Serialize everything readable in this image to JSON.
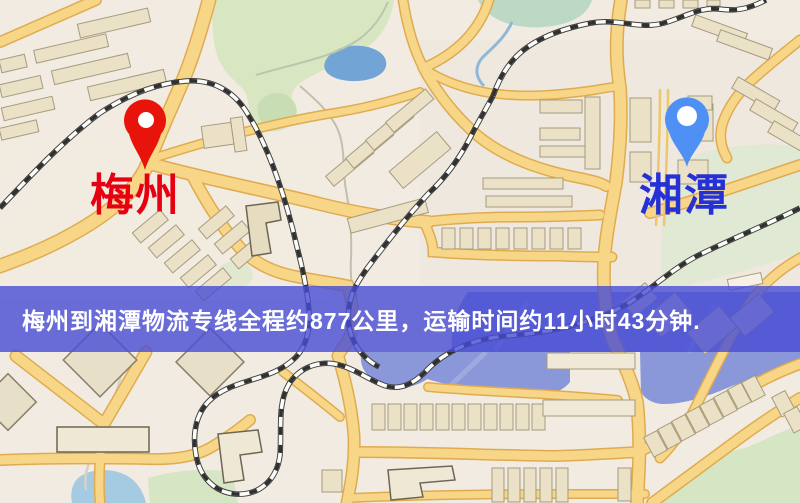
{
  "map": {
    "origin": {
      "label": "梅州",
      "pin_color": "#e8140c",
      "label_color": "#e60012"
    },
    "destination": {
      "label": "湘潭",
      "pin_color": "#4f90f5",
      "label_color": "#2531d6"
    },
    "banner": {
      "text": "梅州到湘潭物流专线全程约877公里，运输时间约11小时43分钟.",
      "background_color": "#474cd4",
      "text_color": "#ffffff"
    },
    "route_summary": {
      "from": "梅州",
      "to": "湘潭",
      "distance": "约877公里",
      "duration": "约11小时43分钟"
    }
  },
  "icons": {
    "origin_pin": "map-pin-icon",
    "destination_pin": "map-pin-icon"
  },
  "palette": {
    "road_fill": "#f7d787",
    "road_casing": "#e0ab50",
    "building_fill": "#eae1c6",
    "park_green": "#d6e5c4",
    "lake_blue": "#72a5d6",
    "river_lavender": "#8a97d8"
  }
}
